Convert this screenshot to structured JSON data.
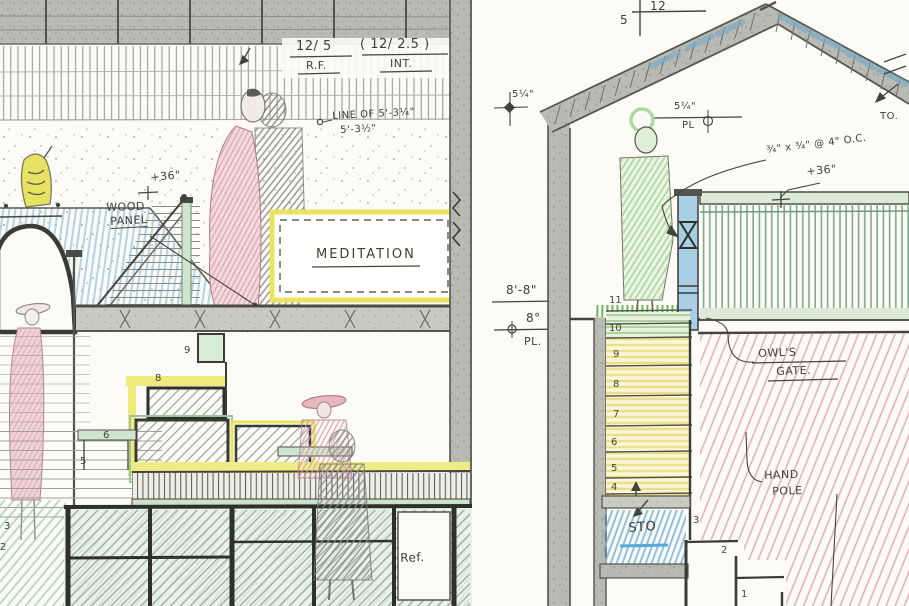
{
  "annotations": {
    "ratio_left_top": "12/ 5",
    "ratio_left_bottom": "R.F.",
    "ratio_right_top": "( 12/ 2.5 )",
    "ratio_right_bottom": "INT.",
    "line_of_1": "LINE OF 5'-3¼\"",
    "line_of_2": "5'-3½\"",
    "wood_panel_1": "WOOD",
    "wood_panel_2": "PANEL",
    "plus36_left": "+36\"",
    "meditation": "MEDITATION",
    "dim_8_8": "8'-8\"",
    "dim_8_0": "8°",
    "dim_pl_left": "PL.",
    "dim_5q_left": "5¼\"",
    "dim_5q_right": "5¼\"",
    "dim_pl_right": "PL",
    "pitch_run": "12",
    "pitch_rise": "5",
    "rail_spec": "¾\" x ¾\" @ 4\" O.C.",
    "plus36_right": "+36\"",
    "owls_1": "OWL'S",
    "owls_2": "GATE.",
    "hand_1": "HAND",
    "hand_2": "POLE",
    "sto": "STO",
    "ref": "Ref.",
    "to": "TO."
  },
  "stair_numbers_right": [
    "11",
    "10",
    "9",
    "8",
    "7",
    "6",
    "5",
    "4"
  ],
  "stair_numbers_lower": [
    "3",
    "2",
    "1"
  ],
  "stair_numbers_left": [
    "9",
    "8",
    "6",
    "5",
    "3",
    "2"
  ],
  "colors": {
    "paper": "#fcfbf6",
    "pencil_band": "#b9bab3",
    "ink": "#44433c",
    "highlight_yellow": "#e9e45e",
    "soffit_blue": "#a7cde2",
    "wall_pink": "#dd9aa4",
    "rail_green": "#7fa98a",
    "post_blue": "#a9cfe4",
    "grass_green": "#5cb04c",
    "sto_blue": "#7db8dc"
  }
}
